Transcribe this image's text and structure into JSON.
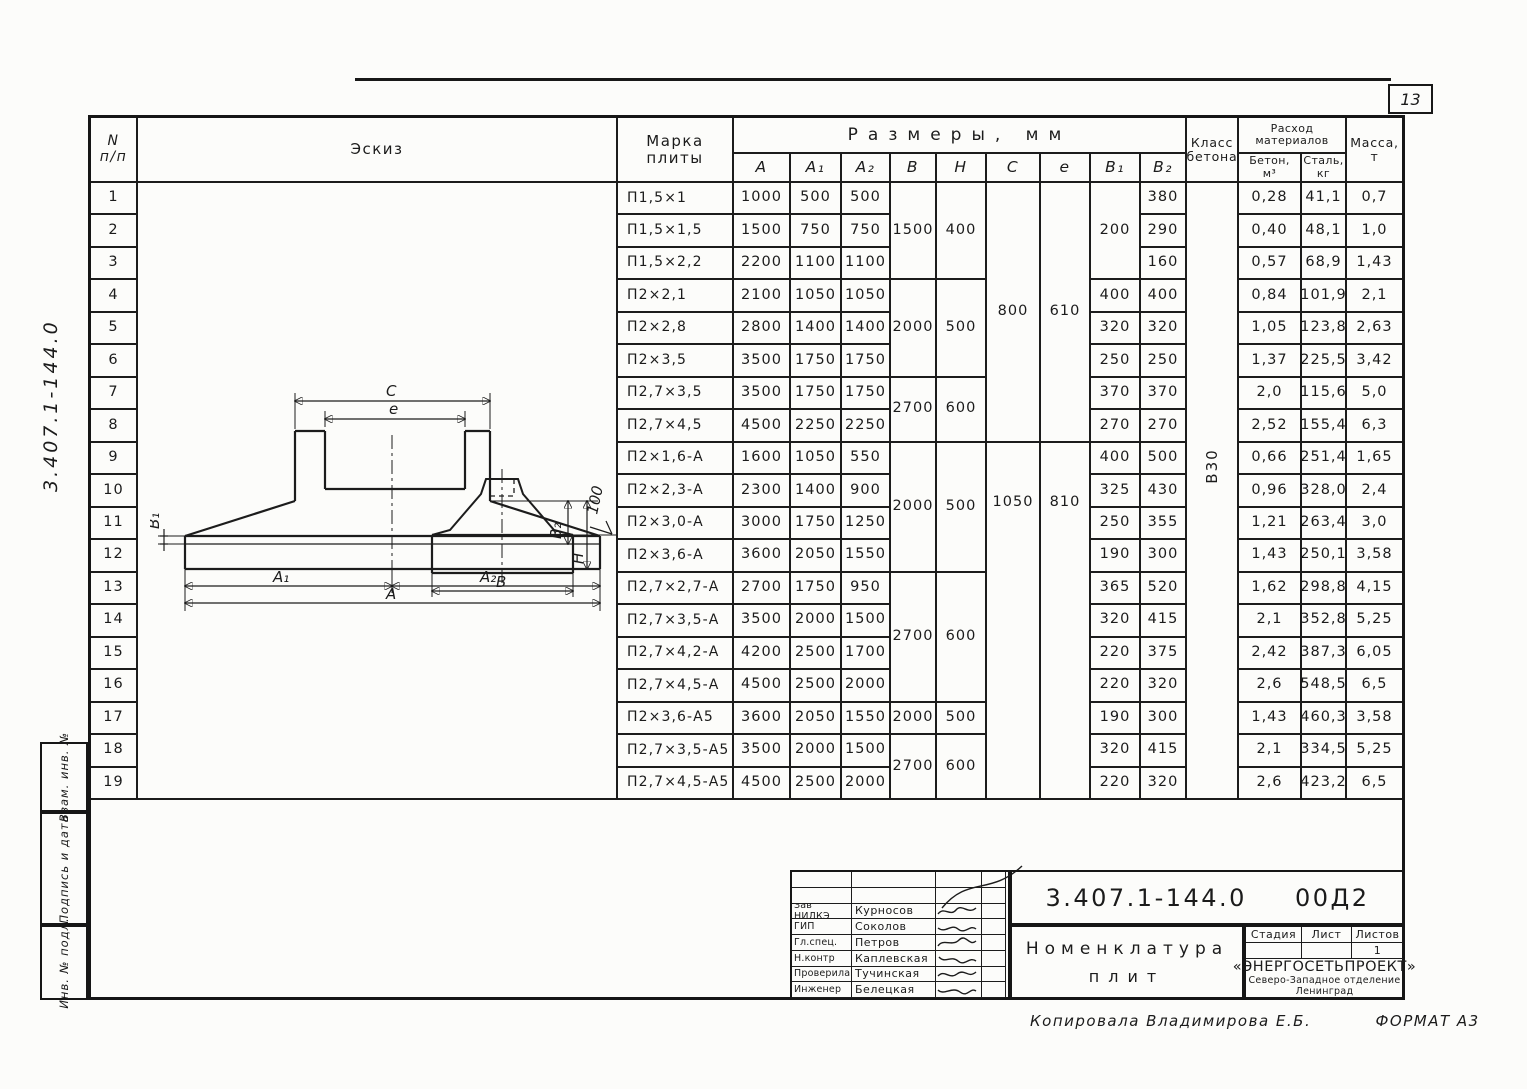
{
  "page": {
    "sheet_number": "13",
    "side_code": "3.407.1-144.0",
    "copied_by": "Копировала Владимирова Е.Б.",
    "format": "ФОРМАТ А3"
  },
  "sidebar": {
    "labels": [
      "Взам. инв. №",
      "Подпись и дата",
      "Инв. № подл."
    ]
  },
  "sketch": {
    "labels": {
      "c": "С",
      "e": "е",
      "b1": "В₁",
      "b2": "В₂",
      "h": "Н",
      "a1": "А₁",
      "a2": "А₂",
      "a": "А",
      "b": "В",
      "slope": "100"
    }
  },
  "table": {
    "headers": {
      "num_lines": [
        "N",
        "п/п"
      ],
      "sketch": "Эскиз",
      "mark_lines": [
        "Марка",
        "плиты"
      ],
      "sizes": "Размеры, мм",
      "size_cols": [
        "А",
        "А₁",
        "А₂",
        "В",
        "Н",
        "С",
        "е",
        "В₁",
        "В₂"
      ],
      "concrete_class_lines": [
        "Класс",
        "бетона"
      ],
      "materials_lines": [
        "Расход",
        "материалов"
      ],
      "material_cols": [
        [
          "Бетон,",
          "м³"
        ],
        [
          "Сталь,",
          "кг"
        ]
      ],
      "mass_lines": [
        "Масса,",
        "т"
      ]
    },
    "concrete_class": "В30",
    "rows": [
      {
        "n": "1",
        "mark": "П1,5×1",
        "a": "1000",
        "a1": "500",
        "a2": "500",
        "b": {
          "v": "1500",
          "span": 3
        },
        "h": {
          "v": "400",
          "span": 3
        },
        "c": {
          "v": "800",
          "span": 8
        },
        "e": {
          "v": "610",
          "span": 8
        },
        "b1": {
          "v": "200",
          "span": 3
        },
        "b2": "380",
        "concrete": "0,28",
        "steel": "41,1",
        "mass": "0,7"
      },
      {
        "n": "2",
        "mark": "П1,5×1,5",
        "a": "1500",
        "a1": "750",
        "a2": "750",
        "b2": "290",
        "concrete": "0,40",
        "steel": "48,1",
        "mass": "1,0"
      },
      {
        "n": "3",
        "mark": "П1,5×2,2",
        "a": "2200",
        "a1": "1100",
        "a2": "1100",
        "b2": "160",
        "concrete": "0,57",
        "steel": "68,9",
        "mass": "1,43"
      },
      {
        "n": "4",
        "mark": "П2×2,1",
        "a": "2100",
        "a1": "1050",
        "a2": "1050",
        "b": {
          "v": "2000",
          "span": 3
        },
        "h": {
          "v": "500",
          "span": 3
        },
        "b1": "400",
        "b2": "400",
        "concrete": "0,84",
        "steel": "101,9",
        "mass": "2,1"
      },
      {
        "n": "5",
        "mark": "П2×2,8",
        "a": "2800",
        "a1": "1400",
        "a2": "1400",
        "b1": "320",
        "b2": "320",
        "concrete": "1,05",
        "steel": "123,8",
        "mass": "2,63"
      },
      {
        "n": "6",
        "mark": "П2×3,5",
        "a": "3500",
        "a1": "1750",
        "a2": "1750",
        "b1": "250",
        "b2": "250",
        "concrete": "1,37",
        "steel": "225,5",
        "mass": "3,42"
      },
      {
        "n": "7",
        "mark": "П2,7×3,5",
        "a": "3500",
        "a1": "1750",
        "a2": "1750",
        "b": {
          "v": "2700",
          "span": 2
        },
        "h": {
          "v": "600",
          "span": 2
        },
        "b1": "370",
        "b2": "370",
        "concrete": "2,0",
        "steel": "115,6",
        "mass": "5,0"
      },
      {
        "n": "8",
        "mark": "П2,7×4,5",
        "a": "4500",
        "a1": "2250",
        "a2": "2250",
        "b1": "270",
        "b2": "270",
        "concrete": "2,52",
        "steel": "155,4",
        "mass": "6,3"
      },
      {
        "n": "9",
        "mark": "П2×1,6-А",
        "a": "1600",
        "a1": "1050",
        "a2": "550",
        "b": {
          "v": "2000",
          "span": 4
        },
        "h": {
          "v": "500",
          "span": 4
        },
        "c": {
          "v": "1050",
          "span": 11
        },
        "e": {
          "v": "810",
          "span": 11
        },
        "b1": "400",
        "b2": "500",
        "concrete": "0,66",
        "steel": "251,4",
        "mass": "1,65"
      },
      {
        "n": "10",
        "mark": "П2×2,3-А",
        "a": "2300",
        "a1": "1400",
        "a2": "900",
        "b1": "325",
        "b2": "430",
        "concrete": "0,96",
        "steel": "328,0",
        "mass": "2,4"
      },
      {
        "n": "11",
        "mark": "П2×3,0-А",
        "a": "3000",
        "a1": "1750",
        "a2": "1250",
        "b1": "250",
        "b2": "355",
        "concrete": "1,21",
        "steel": "263,4",
        "mass": "3,0"
      },
      {
        "n": "12",
        "mark": "П2×3,6-А",
        "a": "3600",
        "a1": "2050",
        "a2": "1550",
        "b1": "190",
        "b2": "300",
        "concrete": "1,43",
        "steel": "250,1",
        "mass": "3,58"
      },
      {
        "n": "13",
        "mark": "П2,7×2,7-А",
        "a": "2700",
        "a1": "1750",
        "a2": "950",
        "b": {
          "v": "2700",
          "span": 4
        },
        "h": {
          "v": "600",
          "span": 4
        },
        "b1": "365",
        "b2": "520",
        "concrete": "1,62",
        "steel": "298,8",
        "mass": "4,15"
      },
      {
        "n": "14",
        "mark": "П2,7×3,5-А",
        "a": "3500",
        "a1": "2000",
        "a2": "1500",
        "b1": "320",
        "b2": "415",
        "concrete": "2,1",
        "steel": "352,8",
        "mass": "5,25"
      },
      {
        "n": "15",
        "mark": "П2,7×4,2-А",
        "a": "4200",
        "a1": "2500",
        "a2": "1700",
        "b1": "220",
        "b2": "375",
        "concrete": "2,42",
        "steel": "387,3",
        "mass": "6,05"
      },
      {
        "n": "16",
        "mark": "П2,7×4,5-А",
        "a": "4500",
        "a1": "2500",
        "a2": "2000",
        "b1": "220",
        "b2": "320",
        "concrete": "2,6",
        "steel": "548,5",
        "mass": "6,5"
      },
      {
        "n": "17",
        "mark": "П2×3,6-А5",
        "a": "3600",
        "a1": "2050",
        "a2": "1550",
        "b": {
          "v": "2000",
          "span": 1
        },
        "h": {
          "v": "500",
          "span": 1
        },
        "b1": "190",
        "b2": "300",
        "concrete": "1,43",
        "steel": "460,3",
        "mass": "3,58"
      },
      {
        "n": "18",
        "mark": "П2,7×3,5-А5",
        "a": "3500",
        "a1": "2000",
        "a2": "1500",
        "b": {
          "v": "2700",
          "span": 2
        },
        "h": {
          "v": "600",
          "span": 2
        },
        "b1": "320",
        "b2": "415",
        "concrete": "2,1",
        "steel": "334,5",
        "mass": "5,25"
      },
      {
        "n": "19",
        "mark": "П2,7×4,5-А5",
        "a": "4500",
        "a1": "2500",
        "a2": "2000",
        "b1": "220",
        "b2": "320",
        "concrete": "2,6",
        "steel": "423,2",
        "mass": "6,5"
      }
    ]
  },
  "title_block": {
    "doc_code": "3.407.1-144.0",
    "doc_suffix": "00Д2",
    "title_line1": "Номенклатура",
    "title_line2": "плит",
    "signatures": [
      {
        "role": "Зав НИЛКЭ",
        "name": "Курносов"
      },
      {
        "role": "ГИП",
        "name": "Соколов"
      },
      {
        "role": "Гл.спец.",
        "name": "Петров"
      },
      {
        "role": "Н.контр",
        "name": "Каплевская"
      },
      {
        "role": "Проверила",
        "name": "Тучинская"
      },
      {
        "role": "Инженер",
        "name": "Белецкая"
      }
    ],
    "stage_label": "Стадия",
    "sheet_label": "Лист",
    "sheets_label": "Листов",
    "sheets_value": "1",
    "org": "«ЭНЕРГОСЕТЬПРОЕКТ»",
    "org_branch": "Северо-Западное отделение",
    "org_city": "Ленинград"
  }
}
